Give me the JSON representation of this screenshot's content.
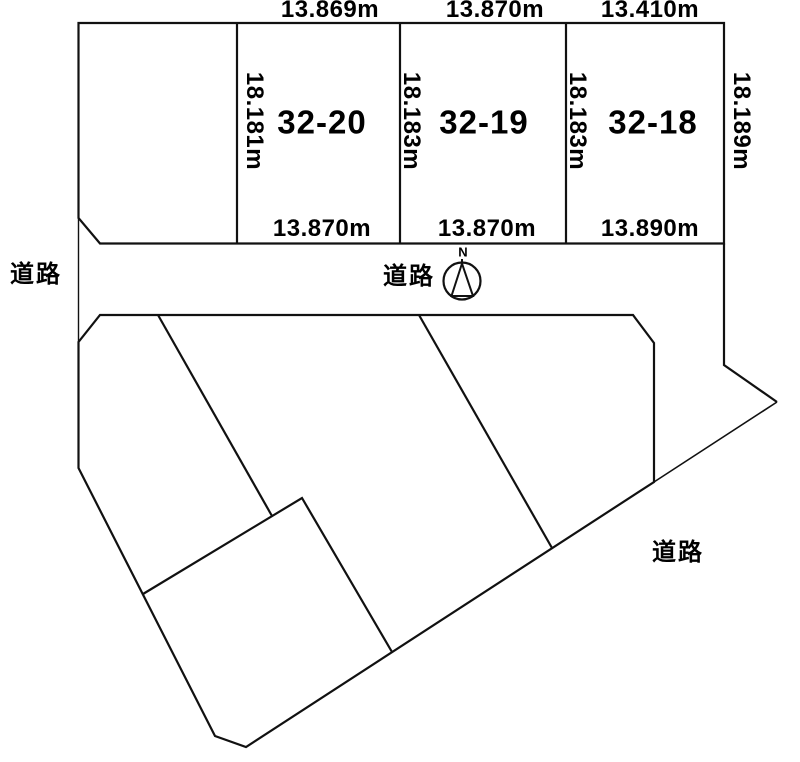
{
  "theme": {
    "background": "#ffffff",
    "line_color": "#111111",
    "text_color": "#000000"
  },
  "upper_section": {
    "plot_names": [
      "32-20",
      "32-19",
      "32-18"
    ],
    "top_measurements": [
      "13.869m",
      "13.870m",
      "13.410m"
    ],
    "bottom_measurements": [
      "13.870m",
      "13.870m",
      "13.890m"
    ],
    "side_measurements": [
      "18.181m",
      "18.183m",
      "18.183m",
      "18.189m"
    ]
  },
  "roads": {
    "left_label": "道路",
    "center_label": "道路",
    "right_label": "道路"
  },
  "compass": {
    "north_label": "N"
  }
}
